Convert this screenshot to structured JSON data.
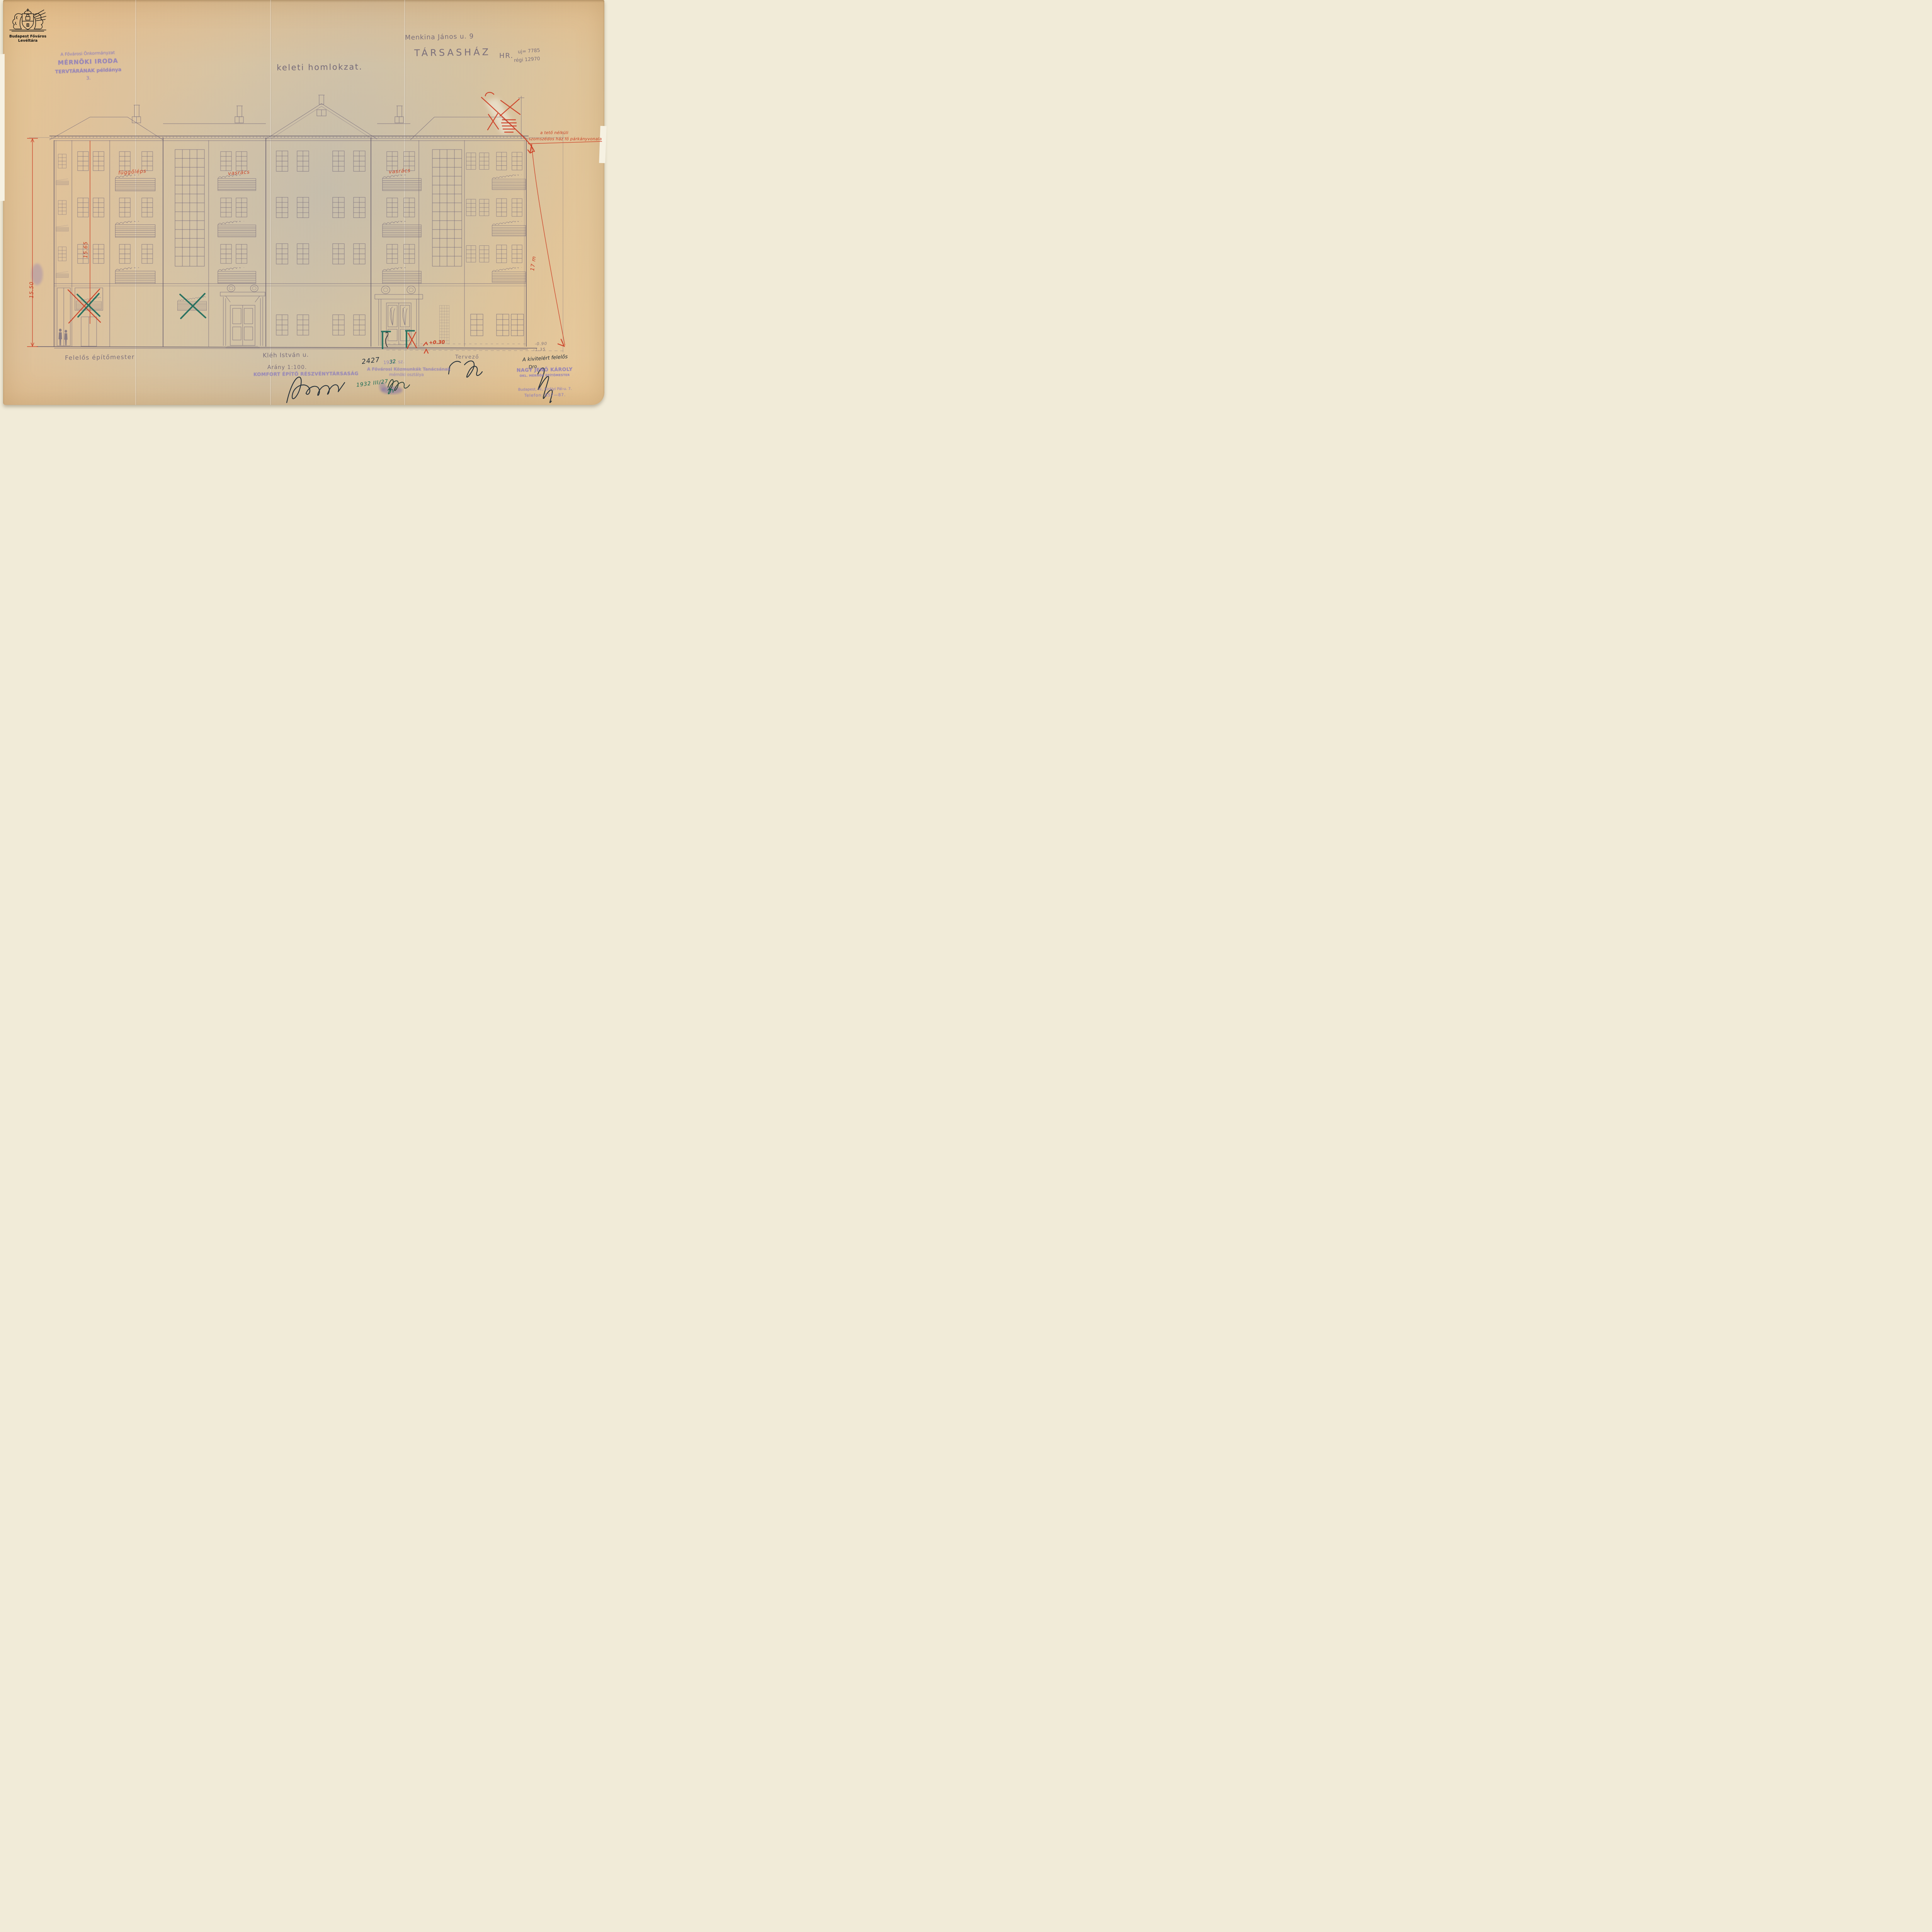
{
  "archive": {
    "label": "Budapest Főváros Levéltára"
  },
  "stamps": {
    "tervtar": {
      "line1": "A Fővárosi Önkormányzat",
      "line2": "MÉRNÖKI IRODA",
      "line3": "TERVTÁRÁNAK példánya",
      "line4": "3."
    },
    "komfort": {
      "label": "KOMFORT ÉPÍTŐ RÉSZVÉNYTÁRSASÁG"
    },
    "kozmunkak": {
      "line1": "A Fővárosi Közmunkák Tanácsának",
      "line2": "mérnöki osztálya"
    },
    "nagy": {
      "line1": "NAGY JENŐ KÁROLY",
      "line2": "OKL. MÉRNÖK ÉPÍTŐMESTER",
      "line3": "Budapest, IV., Királyi Pál-u. 7.",
      "line4": "Telefon: 857—87."
    }
  },
  "header": {
    "street": "Menkina János u. 9",
    "building_type": "TÁRSASHÁZ",
    "hr_label": "HR.",
    "hr_new": "uj= 7785",
    "hr_old": "régi 12970",
    "title": "keleti homlokzat."
  },
  "annotations": {
    "red_note_line1": "a tető nélküli",
    "red_note_line2": "szomszédos ház fő párkányvonala",
    "dim_left": "15.50",
    "dim_inner": "15.65",
    "dim_right": "17 m",
    "level_plus": "+0.30",
    "level_minus_1": "-0.90",
    "level_minus_2": "-1.35",
    "balcony_note_1": "függőléps",
    "balcony_note_2": "vasrács",
    "balcony_note_3": "vasrács",
    "date_green": "1932 III/27",
    "file_number": "2427",
    "file_year": "1932.",
    "file_year_overwrite": "32",
    "file_suffix": "sz."
  },
  "footer": {
    "responsible": "Felelős építőmester",
    "street": "Kléh István u.",
    "scale": "Arány 1:100.",
    "designer": "Tervező",
    "executor_note": "A kivitelért felelős",
    "executor_note2": "Dro"
  },
  "colors": {
    "red_ink": "#cc3a20",
    "green_ink": "#176a52",
    "violet_stamp": "#8577bf",
    "pencil": "#6f6579"
  }
}
